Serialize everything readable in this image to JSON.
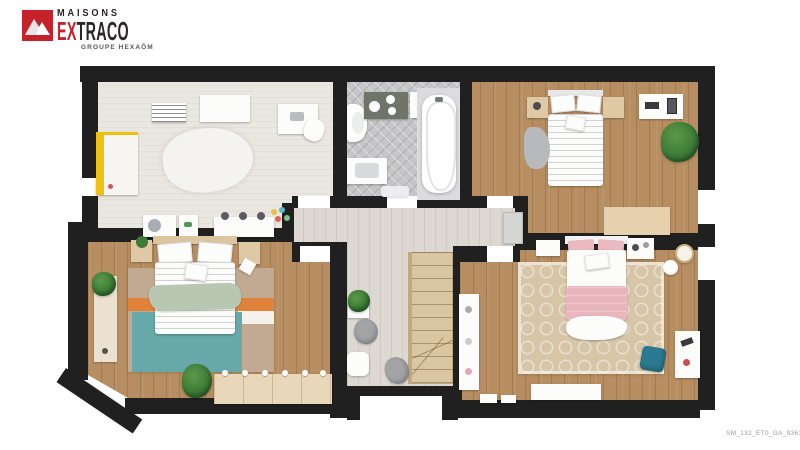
{
  "brand": {
    "logo_icon": "mountain-icon",
    "logo_color": "#c5222b",
    "line1": "MAISONS",
    "line2_red": "EX",
    "line2_dark": "TRACO",
    "line3": "GROUPE HEXAŌM"
  },
  "footer": {
    "reference": "SM_132_ET0_GA_93619"
  },
  "plan": {
    "type": "floor-plan-3d-top-view",
    "colors": {
      "wall": "#202020",
      "wood_floor": "#b78e61",
      "carpet_floor": "#eae6e0",
      "tile_floor": "#c6c6c8",
      "landing_floor": "#ddd8d1",
      "stairs": "#d9c6a2",
      "rug_teal": "#67a8a8",
      "rug_orange": "#e0823a",
      "rug_taupe": "#c2aa92",
      "bed_pink": "#eab6bd",
      "throw_sage": "#b7c7b2",
      "wardrobe_yellow": "#eec00f",
      "ottoman_teal": "#2a7b91",
      "plant_green": "#3c7c36"
    },
    "rooms": [
      {
        "id": "kids-bedroom",
        "position": "top-left",
        "floor": "carpet",
        "furniture": [
          "yellow-wardrobe",
          "radiator",
          "white-table",
          "desk",
          "desk-chair",
          "fluffy-rug",
          "storage-cabinet",
          "small-cabinet",
          "kids-table-with-stools",
          "toys"
        ]
      },
      {
        "id": "bathroom",
        "position": "top-center",
        "floor": "tile",
        "furniture": [
          "toilet",
          "storage-shelf",
          "storage-box",
          "bathtub",
          "vanity-sink",
          "bath-mat"
        ]
      },
      {
        "id": "bedroom-2",
        "position": "top-right",
        "floor": "wood",
        "furniture": [
          "single-bed",
          "nightstand-left",
          "nightstand-right",
          "grey-rug",
          "wall-shelf",
          "plant",
          "bench",
          "corridor-cabinet"
        ]
      },
      {
        "id": "bedroom-3",
        "position": "bottom-left",
        "floor": "wood",
        "furniture": [
          "double-bed",
          "nightstand-left",
          "nightstand-right",
          "striped-rug",
          "plant",
          "dresser",
          "bench",
          "chair"
        ]
      },
      {
        "id": "landing",
        "position": "center",
        "floor": "light-wood",
        "furniture": [
          "staircase",
          "plant-stand",
          "beanbag",
          "side-table",
          "beanbag"
        ]
      },
      {
        "id": "master-bedroom",
        "position": "bottom-right",
        "floor": "wood",
        "furniture": [
          "double-bed-pink",
          "nightstand-left",
          "nightstand-right",
          "trellis-rug",
          "tall-bookshelf",
          "desk",
          "teal-ottoman",
          "round-pouf",
          "round-mirror",
          "console",
          "floor-boxes"
        ]
      }
    ],
    "openings": {
      "doors": 5,
      "windows": 3,
      "stair_notch": 1
    }
  }
}
